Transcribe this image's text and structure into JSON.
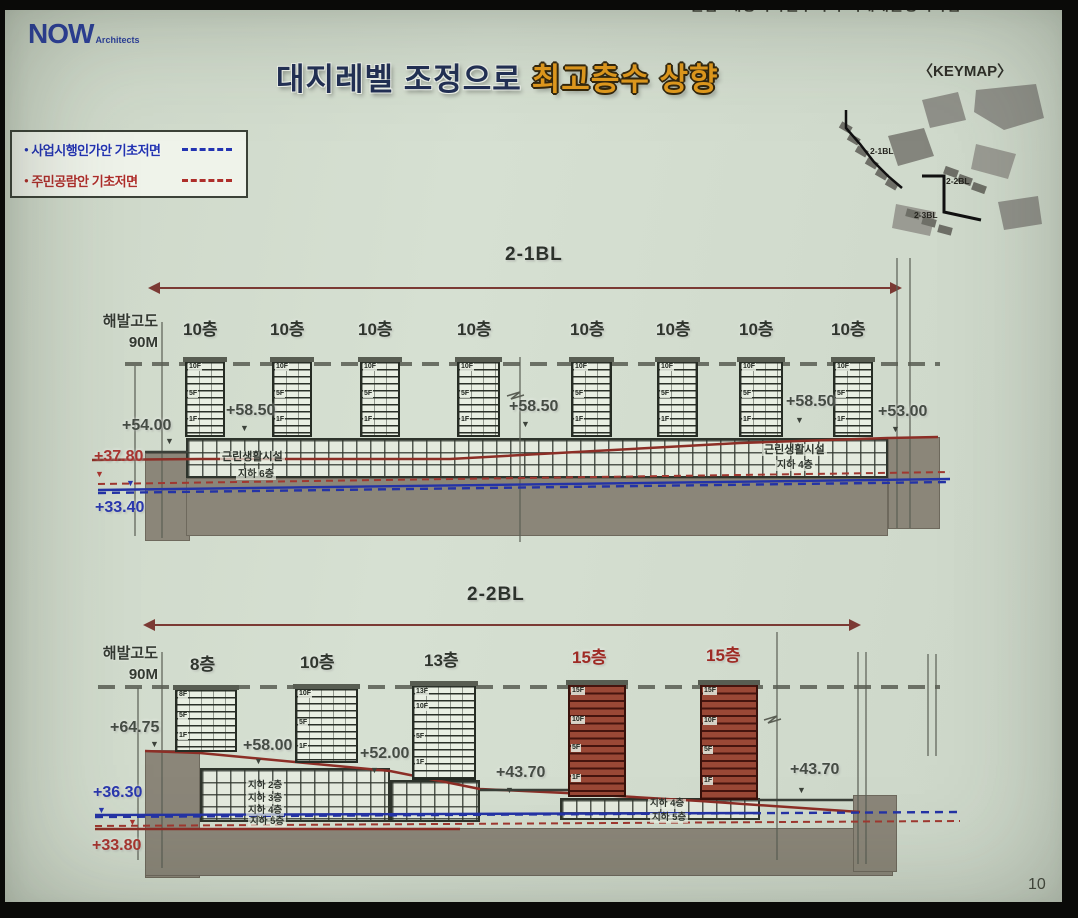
{
  "page": {
    "page_number": "10",
    "slide_bg": "#d3ddd0",
    "frame_color": "#0a0a08"
  },
  "logo": {
    "now": "NOW",
    "architects": "Architects",
    "color": "#2b3f9e"
  },
  "header": {
    "project": "한남2재정비촉진구역 주택재개발정비사업"
  },
  "title": {
    "normal": "대지레벨 조정으로",
    "highlight": "최고층수 상향",
    "highlight_color": "#e29a1d",
    "normal_color": "#223055"
  },
  "keymap": {
    "title": "〈KEYMAP〉",
    "labels": [
      "2-1BL",
      "2-2BL",
      "2-3BL"
    ]
  },
  "legend": {
    "items": [
      {
        "label": "사업시행인가안 기초저면",
        "color": "#2334b2",
        "line_style": "dashed"
      },
      {
        "label": "주민공람안 기초저면",
        "color": "#ae2e2a",
        "line_style": "dashed"
      }
    ]
  },
  "sections": [
    {
      "block_label": "2-1BL",
      "label_x": 505,
      "label_y": 244,
      "sea_level": {
        "line1": "해발고도",
        "line2": "90M",
        "x": 78,
        "y": 311
      },
      "floor_labels": [
        {
          "text": "10층",
          "x": 183,
          "y": 315
        },
        {
          "text": "10층",
          "x": 270,
          "y": 315
        },
        {
          "text": "10층",
          "x": 358,
          "y": 315
        },
        {
          "text": "10층",
          "x": 457,
          "y": 315
        },
        {
          "text": "10층",
          "x": 570,
          "y": 315
        },
        {
          "text": "10층",
          "x": 656,
          "y": 315
        },
        {
          "text": "10층",
          "x": 739,
          "y": 315
        },
        {
          "text": "10층",
          "x": 831,
          "y": 315
        }
      ],
      "buildings": [
        {
          "x": 185,
          "w": 40,
          "top": 360,
          "bot": 437,
          "tags": [
            [
              "10F",
              0.02
            ],
            [
              "5F",
              0.42
            ],
            [
              "1F",
              0.8
            ]
          ]
        },
        {
          "x": 272,
          "w": 40,
          "top": 360,
          "bot": 437,
          "tags": [
            [
              "10F",
              0.02
            ],
            [
              "5F",
              0.42
            ],
            [
              "1F",
              0.8
            ]
          ]
        },
        {
          "x": 360,
          "w": 40,
          "top": 360,
          "bot": 437,
          "tags": [
            [
              "10F",
              0.02
            ],
            [
              "5F",
              0.42
            ],
            [
              "1F",
              0.8
            ]
          ]
        },
        {
          "x": 457,
          "w": 43,
          "top": 360,
          "bot": 437,
          "tags": [
            [
              "10F",
              0.02
            ],
            [
              "5F",
              0.42
            ],
            [
              "1F",
              0.8
            ]
          ]
        },
        {
          "x": 571,
          "w": 41,
          "top": 360,
          "bot": 437,
          "tags": [
            [
              "10F",
              0.02
            ],
            [
              "5F",
              0.42
            ],
            [
              "1F",
              0.8
            ]
          ]
        },
        {
          "x": 657,
          "w": 41,
          "top": 360,
          "bot": 437,
          "tags": [
            [
              "10F",
              0.02
            ],
            [
              "5F",
              0.42
            ],
            [
              "1F",
              0.8
            ]
          ]
        },
        {
          "x": 739,
          "w": 44,
          "top": 360,
          "bot": 437,
          "tags": [
            [
              "10F",
              0.02
            ],
            [
              "5F",
              0.42
            ],
            [
              "1F",
              0.8
            ]
          ]
        },
        {
          "x": 833,
          "w": 40,
          "top": 360,
          "bot": 437,
          "tags": [
            [
              "10F",
              0.02
            ],
            [
              "5F",
              0.42
            ],
            [
              "1F",
              0.8
            ]
          ]
        }
      ],
      "grids": [
        {
          "x": 186,
          "y": 438,
          "w": 702,
          "h": 40
        }
      ],
      "grounds": [
        {
          "x": 145,
          "y": 453,
          "w": 45,
          "h": 88
        },
        {
          "x": 186,
          "y": 478,
          "w": 702,
          "h": 58
        },
        {
          "x": 888,
          "y": 437,
          "w": 52,
          "h": 92
        }
      ],
      "elevations": [
        {
          "text": "+54.00",
          "x": 122,
          "y": 417,
          "mx": 165,
          "my": 437
        },
        {
          "text": "+58.50",
          "x": 226,
          "y": 402,
          "mx": 240,
          "my": 424
        },
        {
          "text": "+58.50",
          "x": 509,
          "y": 398,
          "mx": 521,
          "my": 420
        },
        {
          "text": "+58.50",
          "x": 786,
          "y": 393,
          "mx": 795,
          "my": 416
        },
        {
          "text": "+53.00",
          "x": 878,
          "y": 403,
          "mx": 891,
          "my": 425
        },
        {
          "text": "+37.80",
          "x": 94,
          "y": 448,
          "cls": "red",
          "mx": 95,
          "my": 470
        },
        {
          "text": "+33.40",
          "x": 95,
          "y": 499,
          "cls": "blue",
          "mx": 126,
          "my": 479
        }
      ],
      "notes": [
        {
          "text": "근린생활시설",
          "x": 220,
          "y": 451,
          "s": 11
        },
        {
          "text": "지하 6층",
          "x": 236,
          "y": 469,
          "s": 10
        },
        {
          "text": "근린생활시설",
          "x": 762,
          "y": 444,
          "s": 11
        },
        {
          "text": "지하 4층",
          "x": 775,
          "y": 460,
          "s": 10
        }
      ]
    },
    {
      "block_label": "2-2BL",
      "label_x": 467,
      "label_y": 584,
      "sea_level": {
        "line1": "해발고도",
        "line2": "90M",
        "x": 78,
        "y": 643
      },
      "floor_labels": [
        {
          "text": "8층",
          "x": 190,
          "y": 650
        },
        {
          "text": "10층",
          "x": 300,
          "y": 648
        },
        {
          "text": "13층",
          "x": 424,
          "y": 646
        },
        {
          "text": "15층",
          "x": 572,
          "y": 643,
          "red": true
        },
        {
          "text": "15층",
          "x": 706,
          "y": 641,
          "red": true
        }
      ],
      "buildings": [
        {
          "x": 175,
          "w": 62,
          "top": 688,
          "bot": 752,
          "tags": [
            [
              "8F",
              0.02
            ],
            [
              "5F",
              0.4
            ],
            [
              "1F",
              0.78
            ]
          ]
        },
        {
          "x": 295,
          "w": 63,
          "top": 687,
          "bot": 763,
          "tags": [
            [
              "10F",
              0.02
            ],
            [
              "5F",
              0.45
            ],
            [
              "1F",
              0.82
            ]
          ]
        },
        {
          "x": 412,
          "w": 64,
          "top": 684,
          "bot": 780,
          "tags": [
            [
              "13F",
              0.02
            ],
            [
              "10F",
              0.2
            ],
            [
              "5F",
              0.55
            ],
            [
              "1F",
              0.85
            ]
          ]
        },
        {
          "x": 568,
          "w": 58,
          "top": 683,
          "bot": 797,
          "red": true,
          "tags": [
            [
              "15F",
              0.02
            ],
            [
              "10F",
              0.3
            ],
            [
              "5F",
              0.57
            ],
            [
              "1F",
              0.86
            ]
          ]
        },
        {
          "x": 700,
          "w": 58,
          "top": 683,
          "bot": 800,
          "red": true,
          "tags": [
            [
              "15F",
              0.02
            ],
            [
              "10F",
              0.3
            ],
            [
              "5F",
              0.57
            ],
            [
              "1F",
              0.86
            ]
          ]
        }
      ],
      "grids": [
        {
          "x": 200,
          "y": 768,
          "w": 190,
          "h": 54
        },
        {
          "x": 390,
          "y": 780,
          "w": 90,
          "h": 42
        },
        {
          "x": 560,
          "y": 798,
          "w": 200,
          "h": 22
        }
      ],
      "grounds": [
        {
          "x": 145,
          "y": 750,
          "w": 55,
          "h": 128
        },
        {
          "x": 145,
          "y": 828,
          "w": 748,
          "h": 48
        },
        {
          "x": 853,
          "y": 795,
          "w": 44,
          "h": 77
        }
      ],
      "elevations": [
        {
          "text": "+64.75",
          "x": 110,
          "y": 719,
          "mx": 150,
          "my": 740
        },
        {
          "text": "+58.00",
          "x": 243,
          "y": 737,
          "mx": 254,
          "my": 757
        },
        {
          "text": "+52.00",
          "x": 360,
          "y": 745,
          "mx": 370,
          "my": 766
        },
        {
          "text": "+43.70",
          "x": 496,
          "y": 764,
          "mx": 505,
          "my": 786
        },
        {
          "text": "+43.70",
          "x": 790,
          "y": 761,
          "mx": 797,
          "my": 786
        },
        {
          "text": "+36.30",
          "x": 93,
          "y": 784,
          "cls": "blue",
          "mx": 97,
          "my": 806
        },
        {
          "text": "+33.80",
          "x": 92,
          "y": 837,
          "cls": "red",
          "mx": 128,
          "my": 818
        }
      ],
      "notes": [
        {
          "text": "지하 2층",
          "x": 246,
          "y": 781,
          "s": 9.5
        },
        {
          "text": "지하 3층",
          "x": 246,
          "y": 794,
          "s": 9.5
        },
        {
          "text": "지하 4층",
          "x": 246,
          "y": 806,
          "s": 9.5
        },
        {
          "text": "지하 5층",
          "x": 248,
          "y": 817,
          "s": 9.5
        },
        {
          "text": "지하 4층",
          "x": 648,
          "y": 799,
          "s": 9.5
        },
        {
          "text": "지하 5층",
          "x": 650,
          "y": 813,
          "s": 9.5
        }
      ]
    }
  ]
}
